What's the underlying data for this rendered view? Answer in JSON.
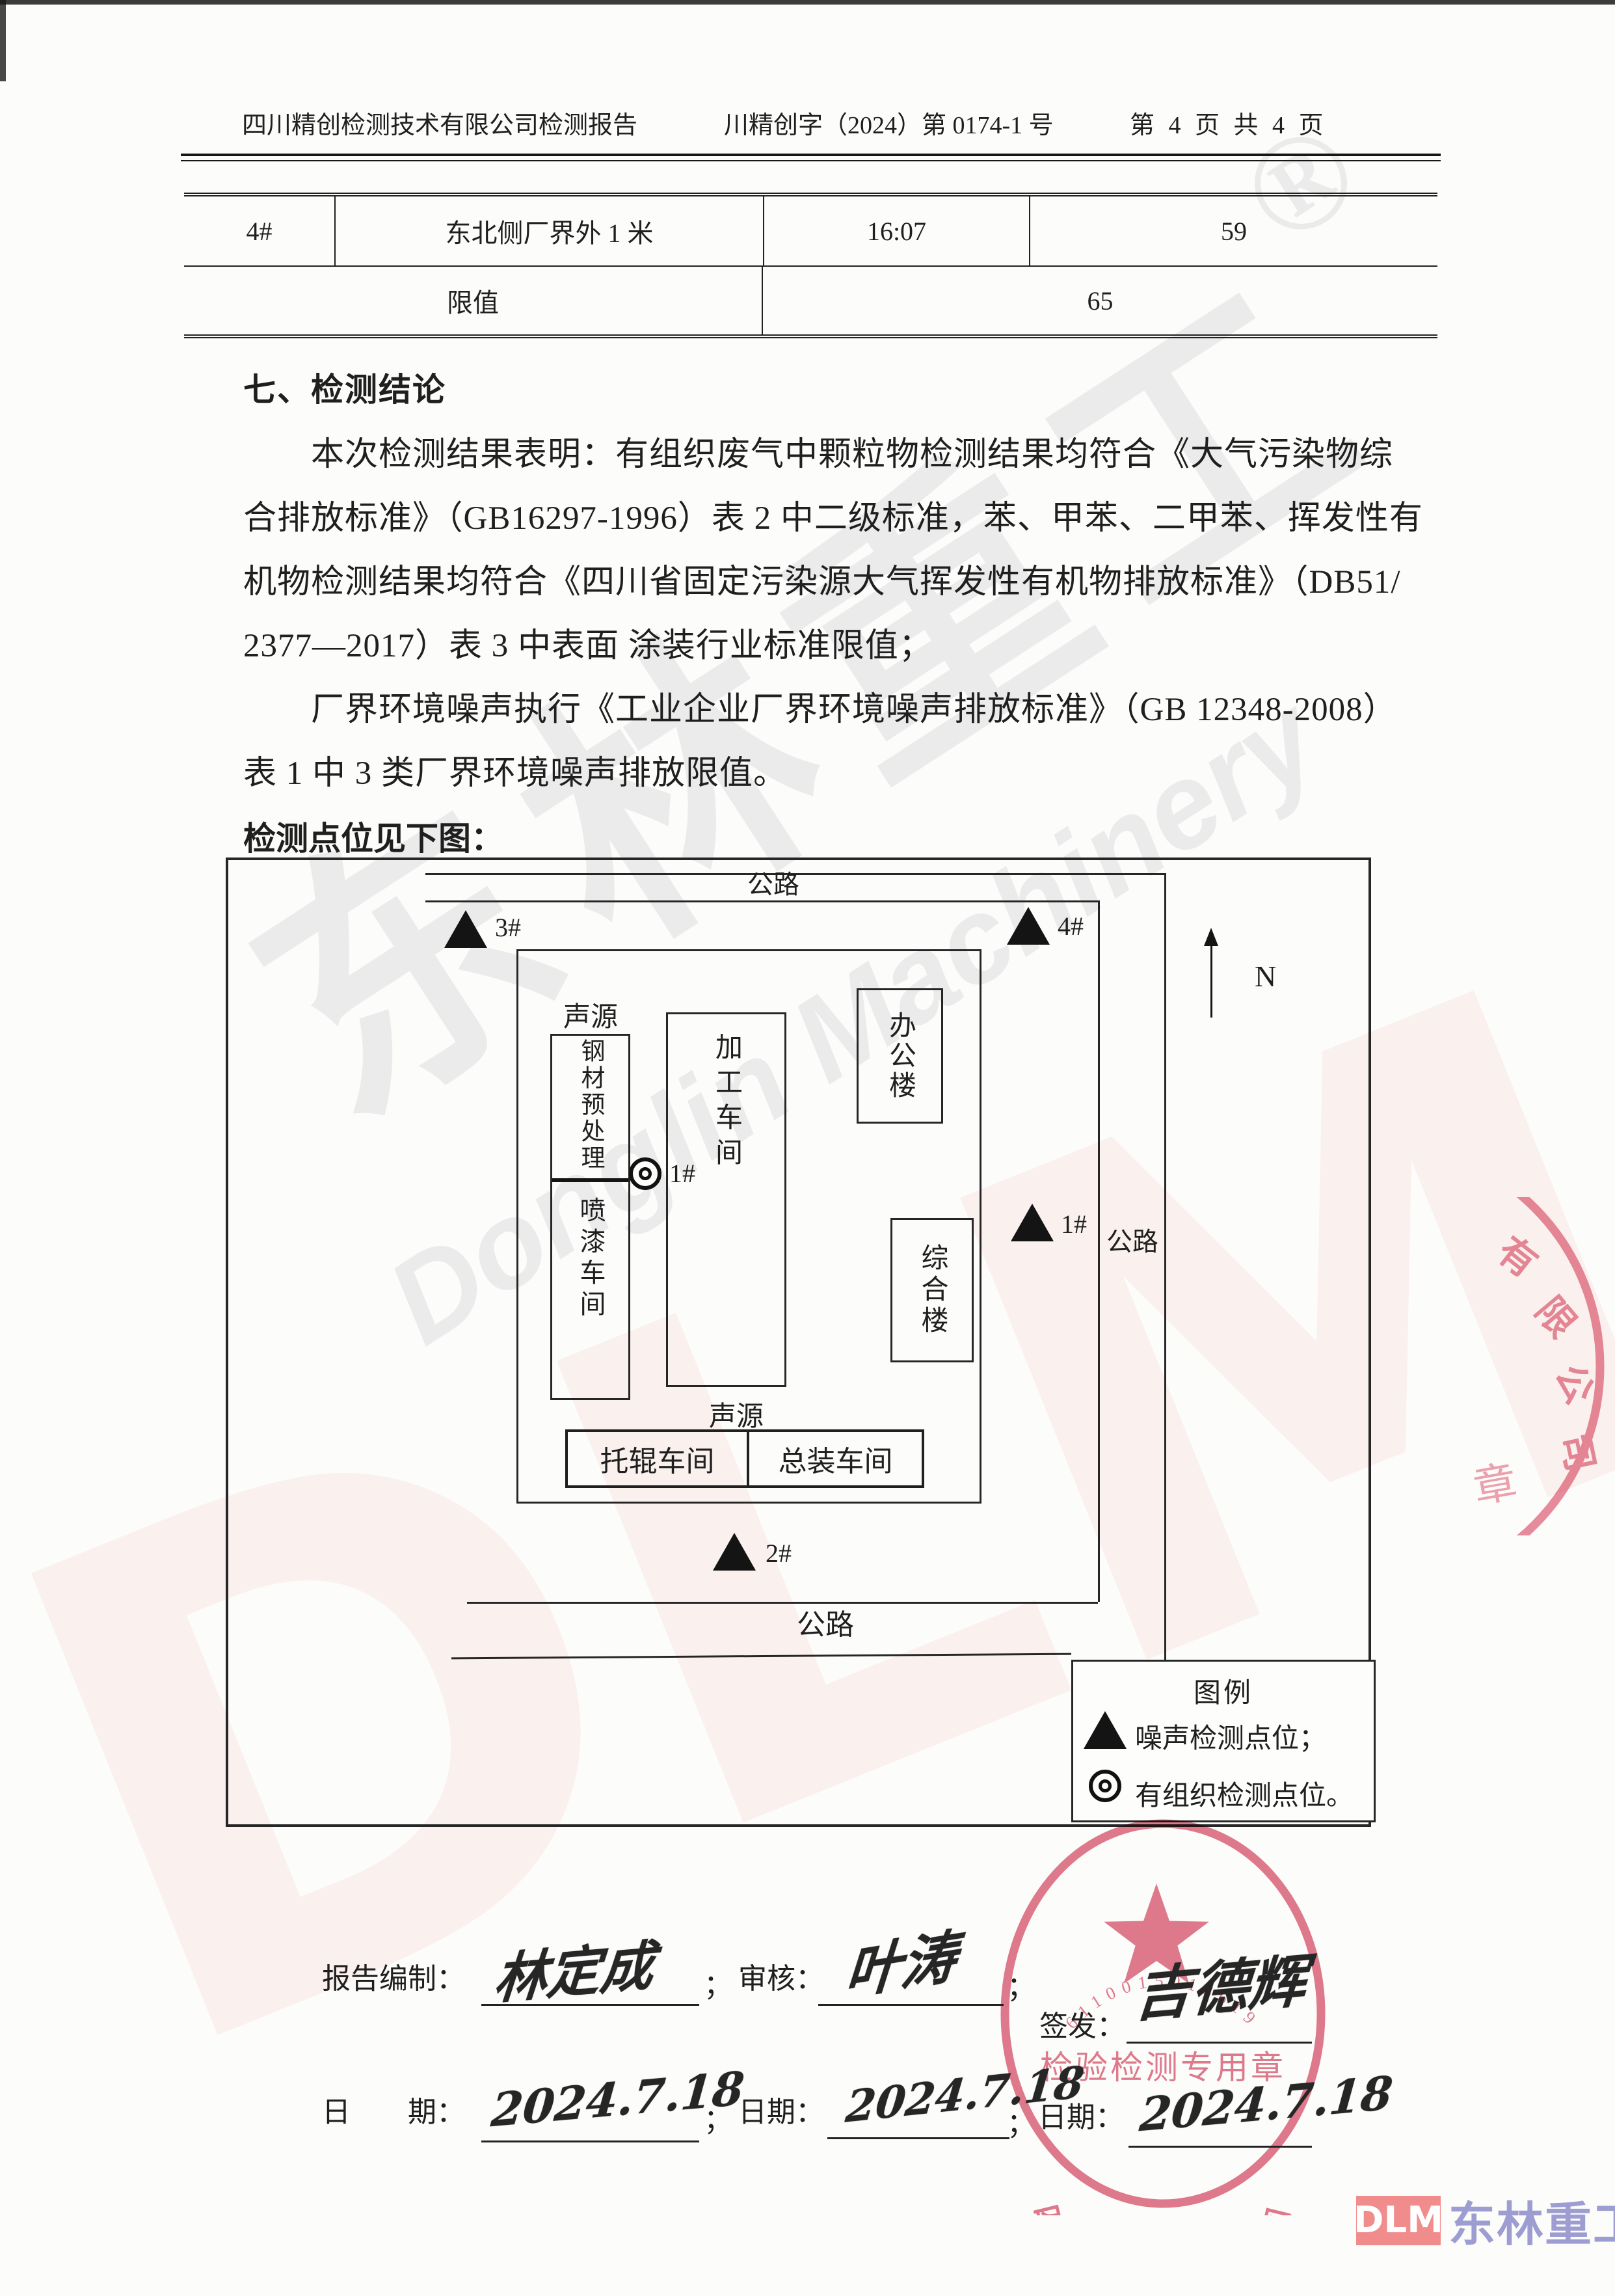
{
  "header": {
    "title": "四川精创检测技术有限公司检测报告",
    "report_no": "川精创字（2024）第 0174-1 号",
    "page_info": "第 4 页 共 4 页"
  },
  "noise_table": {
    "row": {
      "point": "4#",
      "location": "东北侧厂界外 1 米",
      "time": "16:07",
      "value": "59"
    },
    "limit": {
      "label": "限值",
      "value": "65"
    }
  },
  "conclusion": {
    "heading": "七、检测结论",
    "lines": [
      "本次检测结果表明：有组织废气中颗粒物检测结果均符合《大气污染物综",
      "合排放标准》（GB16297-1996）表 2 中二级标准，苯、甲苯、二甲苯、挥发性有",
      "机物检测结果均符合《四川省固定污染源大气挥发性有机物排放标准》（DB51/",
      "2377—2017）表 3 中表面 涂装行业标准限值；",
      "厂界环境噪声执行《工业企业厂界环境噪声排放标准》（GB 12348-2008）",
      "表 1 中 3 类厂界环境噪声排放限值。"
    ],
    "map_intro": "检测点位见下图："
  },
  "site_map": {
    "roads": {
      "top": "公路",
      "right": "公路",
      "bottom": "公路"
    },
    "north": "N",
    "source_label_top": "声源",
    "source_label_bottom": "声源",
    "buildings": {
      "steel": "钢材预处理",
      "paint": "喷漆车间",
      "processing": "加工车间",
      "office": "办公楼",
      "complex": "综合楼",
      "roller": "托辊车间",
      "assembly": "总装车间"
    },
    "points": {
      "p1": "1#",
      "p2": "2#",
      "p3": "3#",
      "p4": "4#",
      "organized": "1#"
    },
    "legend": {
      "title": "图例",
      "noise_item": "噪声检测点位；",
      "organized_item": "有组织检测点位。"
    }
  },
  "signatures": {
    "prepared_label": "报告编制：",
    "prepared_name": "林定成",
    "review_label": "审核：",
    "review_name": "叶涛",
    "issue_label": "签发：",
    "issue_name": "吉德辉",
    "date_label_wide": "日　　期：",
    "date_label": "日期：",
    "date1": "2024.7.18",
    "date2": "2024.7.18",
    "date3": "2024.7.18",
    "sep": "；"
  },
  "stamps": {
    "main": {
      "arc_text": "四川精创检测技术有限公司",
      "center_text": "检验检测专用章",
      "serial": "6110015018619",
      "color": "#d95d75"
    },
    "edge": {
      "c1": "有",
      "c2": "限",
      "c3": "公",
      "c4": "司",
      "c5": "章"
    }
  },
  "watermark": {
    "cn": "东林重工",
    "reg": "®",
    "en": "Donglin Machinery",
    "abbr": "DLM"
  },
  "footer_logo": {
    "abbr": "DLM",
    "name": "东林重工"
  }
}
